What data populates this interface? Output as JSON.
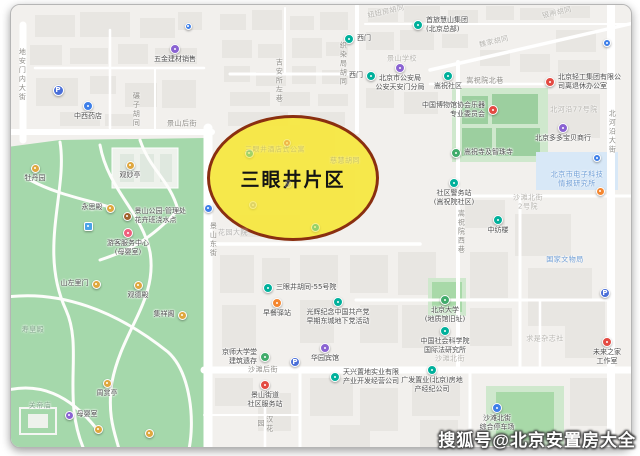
{
  "page": {
    "watermark": "搜狐号@北京安置房大全"
  },
  "map": {
    "highlight": {
      "label": "三眼井片区",
      "fill_color": "#f6e73d",
      "border_color": "#8a2f10"
    },
    "palette": {
      "teal": "#00b09b",
      "purple": "#8a63d2",
      "orange": "#f5862f",
      "red": "#e34a42",
      "blue": "#3e7fe8",
      "parking": "#4a6fd8",
      "pink": "#ef5f7e",
      "amber": "#dfa73e",
      "brown": "#a0622d",
      "green": "#41ab6b",
      "lightblue": "#4aa3e8",
      "gray": "#a8a8a8"
    },
    "markers": [
      {
        "x": 175,
        "y": 49,
        "color": "purple",
        "label": "五金建材销售",
        "pos": "below"
      },
      {
        "x": 188,
        "y": 26,
        "color": "blue",
        "size": 7
      },
      {
        "x": 58,
        "y": 90,
        "color": "parking",
        "glyph": "P",
        "size": 11
      },
      {
        "x": 88,
        "y": 106,
        "color": "blue",
        "label": "中西药店",
        "pos": "below"
      },
      {
        "x": 349,
        "y": 39,
        "color": "teal",
        "label": "西门",
        "pos": "right"
      },
      {
        "x": 418,
        "y": 25,
        "color": "teal",
        "label": "首旅慧山集团\n(北京总部)",
        "pos": "right"
      },
      {
        "x": 371,
        "y": 76,
        "color": "teal",
        "label": "西门",
        "pos": "left"
      },
      {
        "x": 400,
        "y": 68,
        "color": "purple",
        "label": "北京市公安局\n公安天安门分局",
        "pos": "below"
      },
      {
        "x": 448,
        "y": 76,
        "color": "teal",
        "label": "嵩祝社区",
        "pos": "below"
      },
      {
        "x": 550,
        "y": 82,
        "color": "red",
        "label": "北京轻工集团有限公\n司离退休办公室",
        "pos": "right"
      },
      {
        "x": 607,
        "y": 43,
        "color": "blue",
        "size": 8
      },
      {
        "x": 493,
        "y": 110,
        "color": "red",
        "label": "中国博物馆协会乐器\n专业委员会",
        "pos": "left"
      },
      {
        "x": 456,
        "y": 153,
        "color": "green",
        "label": "嵩祝寺及智珠寺",
        "pos": "right"
      },
      {
        "x": 454,
        "y": 183,
        "color": "teal",
        "label": "社区警务站\n(嵩祝院社区)",
        "pos": "below"
      },
      {
        "x": 563,
        "y": 128,
        "color": "purple",
        "label": "北京多多宝贝商行",
        "pos": "below"
      },
      {
        "x": 597,
        "y": 158,
        "color": "blue",
        "size": 8
      },
      {
        "x": 600,
        "y": 191,
        "color": "orange",
        "size": 9
      },
      {
        "x": 498,
        "y": 220,
        "color": "teal",
        "label": "中纺楼",
        "pos": "below"
      },
      {
        "x": 208,
        "y": 208,
        "color": "blue",
        "size": 9
      },
      {
        "x": 268,
        "y": 288,
        "color": "teal",
        "label": "三眼井胡同-55号院",
        "pos": "right"
      },
      {
        "x": 277,
        "y": 303,
        "color": "orange",
        "label": "早餐驿站",
        "pos": "below"
      },
      {
        "x": 338,
        "y": 302,
        "color": "teal",
        "label": "光辉纪念中国共产党\n早期东城地下党活动",
        "pos": "below"
      },
      {
        "x": 265,
        "y": 357,
        "color": "green",
        "label": "京师大学堂\n建筑遗存",
        "pos": "left"
      },
      {
        "x": 295,
        "y": 362,
        "color": "parking",
        "glyph": "P",
        "size": 10
      },
      {
        "x": 325,
        "y": 348,
        "color": "purple",
        "label": "华园宾馆",
        "pos": "below"
      },
      {
        "x": 265,
        "y": 385,
        "color": "red",
        "label": "景山街道\n社区服务站",
        "pos": "below"
      },
      {
        "x": 335,
        "y": 377,
        "color": "teal",
        "label": "天兴置地实业有限\n产业开发经营公司",
        "pos": "right"
      },
      {
        "x": 445,
        "y": 300,
        "color": "green",
        "label": "北京大学\n(地质馆旧址)",
        "pos": "below"
      },
      {
        "x": 445,
        "y": 331,
        "color": "teal",
        "label": "中国社会科学院\n国际法研究所",
        "pos": "below"
      },
      {
        "x": 432,
        "y": 370,
        "color": "teal",
        "label": "广发置业(北京)房地\n产经纪公司",
        "pos": "below"
      },
      {
        "x": 497,
        "y": 408,
        "color": "blue",
        "label": "沙滩北街\n综合停车场",
        "pos": "below"
      },
      {
        "x": 605,
        "y": 293,
        "color": "parking",
        "glyph": "P",
        "size": 10
      },
      {
        "x": 607,
        "y": 342,
        "color": "red",
        "label": "未来之家\n工作室",
        "pos": "below"
      },
      {
        "x": 35,
        "y": 168,
        "color": "amber",
        "label": "牡丹园",
        "pos": "below",
        "size": 9
      },
      {
        "x": 130,
        "y": 165,
        "color": "amber",
        "label": "观妙亭",
        "pos": "below",
        "size": 9
      },
      {
        "x": 110,
        "y": 208,
        "color": "amber",
        "label": "永思殿",
        "pos": "left",
        "size": 9
      },
      {
        "x": 127,
        "y": 216,
        "color": "brown",
        "label": "景山公园-管理处\n花卉班浇水点",
        "pos": "right",
        "size": 9
      },
      {
        "x": 88,
        "y": 226,
        "color": "lightblue",
        "shape": "sq",
        "size": 9
      },
      {
        "x": 128,
        "y": 233,
        "color": "pink",
        "label": "游客服务中心\n(母婴室)",
        "pos": "below",
        "size": 10
      },
      {
        "x": 96,
        "y": 284,
        "color": "amber",
        "label": "山左里门",
        "pos": "left",
        "size": 9
      },
      {
        "x": 138,
        "y": 285,
        "color": "amber",
        "label": "观德殿",
        "pos": "below",
        "size": 9
      },
      {
        "x": 182,
        "y": 315,
        "color": "amber",
        "label": "集祥阁",
        "pos": "left",
        "size": 9
      },
      {
        "x": 107,
        "y": 383,
        "color": "amber",
        "label": "周赏亭",
        "pos": "below",
        "size": 9
      },
      {
        "x": 69,
        "y": 415,
        "color": "purple",
        "label": "母婴室",
        "pos": "right",
        "size": 9
      },
      {
        "x": 98,
        "y": 429,
        "color": "amber",
        "size": 9
      },
      {
        "x": 149,
        "y": 433,
        "color": "amber",
        "size": 9
      },
      {
        "x": 249,
        "y": 153,
        "color": "teal",
        "opacity": 0.35,
        "size": 9
      },
      {
        "x": 287,
        "y": 143,
        "color": "red",
        "opacity": 0.3,
        "size": 8
      },
      {
        "x": 288,
        "y": 184,
        "color": "gray",
        "opacity": 0.3,
        "size": 8
      },
      {
        "x": 315,
        "y": 227,
        "color": "teal",
        "opacity": 0.4,
        "size": 9
      },
      {
        "x": 253,
        "y": 205,
        "color": "gray",
        "opacity": 0.3,
        "size": 8
      }
    ],
    "labels": [
      {
        "text": "地安门内大街",
        "x": 22,
        "y": 75,
        "v": true,
        "type": "street"
      },
      {
        "text": "碾子胡同",
        "x": 136,
        "y": 110,
        "v": true,
        "type": "street"
      },
      {
        "text": "景山后街",
        "x": 182,
        "y": 124,
        "type": "street"
      },
      {
        "text": "吉安所左巷",
        "x": 279,
        "y": 81,
        "v": true,
        "type": "street"
      },
      {
        "text": "织染局胡同",
        "x": 343,
        "y": 64,
        "v": true,
        "type": "street"
      },
      {
        "text": "景山学校",
        "x": 402,
        "y": 59,
        "type": "faint"
      },
      {
        "text": "魏家胡同",
        "x": 494,
        "y": 42,
        "rot": -13,
        "type": "faint"
      },
      {
        "text": "妞妞房胡同",
        "x": 386,
        "y": 12,
        "rot": -13,
        "type": "faint"
      },
      {
        "text": "银闸胡同",
        "x": 557,
        "y": 13,
        "rot": -13,
        "type": "faint"
      },
      {
        "text": "嵩祝院北巷",
        "x": 485,
        "y": 81,
        "type": "street"
      },
      {
        "text": "北河沿77号院",
        "x": 574,
        "y": 110,
        "type": "faint"
      },
      {
        "text": "北河沿大街",
        "x": 612,
        "y": 132,
        "v": true,
        "type": "street"
      },
      {
        "text": "沙滩北街\n2号院",
        "x": 528,
        "y": 202,
        "type": "faint"
      },
      {
        "text": "嵩祝院西巷",
        "x": 461,
        "y": 232,
        "v": true,
        "type": "street"
      },
      {
        "text": "国家文物局",
        "x": 565,
        "y": 260,
        "type": "blue"
      },
      {
        "text": "北京市电子科技\n情报研究所",
        "x": 577,
        "y": 179,
        "type": "blue"
      },
      {
        "text": "景山东街",
        "x": 213,
        "y": 240,
        "v": true,
        "type": "street"
      },
      {
        "text": "沙滩后街",
        "x": 263,
        "y": 370,
        "type": "street"
      },
      {
        "text": "沙滩北街",
        "x": 450,
        "y": 359,
        "type": "faint"
      },
      {
        "text": "求是杂志社",
        "x": 545,
        "y": 339,
        "type": "faint"
      },
      {
        "text": "汉花园",
        "x": 265,
        "y": 424,
        "v": true,
        "type": "street"
      },
      {
        "text": "寿皇殿",
        "x": 33,
        "y": 330,
        "type": "park"
      },
      {
        "text": "关帝庙",
        "x": 40,
        "y": 406,
        "type": "park"
      },
      {
        "text": "三眼井酒店式公寓",
        "x": 275,
        "y": 150,
        "type": "inner",
        "opacity": 0.35
      },
      {
        "text": "慈慧胡同",
        "x": 345,
        "y": 161,
        "type": "inner",
        "opacity": 0.4
      },
      {
        "text": "花园大院",
        "x": 233,
        "y": 233,
        "type": "inner",
        "opacity": 0.55
      }
    ]
  }
}
